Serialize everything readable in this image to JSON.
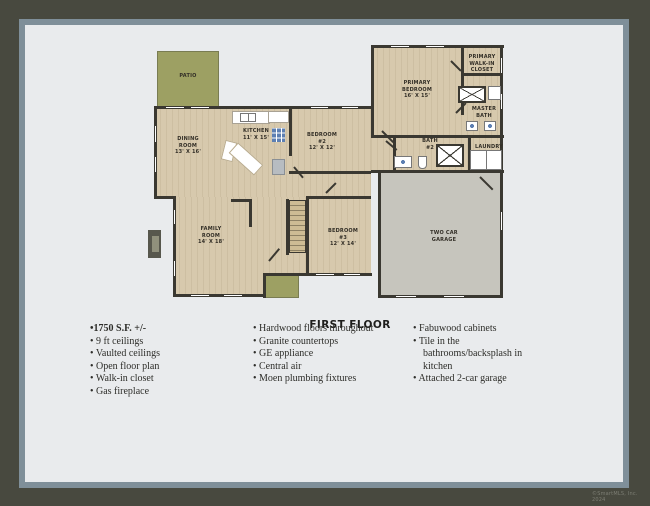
{
  "plan": {
    "title": "FIRST FLOOR",
    "rooms": [
      {
        "id": "patio",
        "label": "PATIO"
      },
      {
        "id": "dining-room",
        "label": "DINING\nROOM\n13' X 16'"
      },
      {
        "id": "kitchen",
        "label": "KITCHEN\n11' X 15'"
      },
      {
        "id": "bedroom-2",
        "label": "BEDROOM\n#2\n12' X 12'"
      },
      {
        "id": "primary-bedroom",
        "label": "PRIMARY\nBEDROOM\n16' X 15'"
      },
      {
        "id": "primary-walk-in-closet",
        "label": "PRIMARY\nWALK-IN\nCLOSET"
      },
      {
        "id": "master-bath",
        "label": "MASTER\nBATH"
      },
      {
        "id": "bath-2",
        "label": "BATH\n#2"
      },
      {
        "id": "laundry",
        "label": "LAUNDRY"
      },
      {
        "id": "family-room",
        "label": "FAMILY\nROOM\n14' X 18'"
      },
      {
        "id": "bedroom-3",
        "label": "BEDROOM\n#3\n12' X 14'"
      },
      {
        "id": "two-car-garage",
        "label": "TWO CAR\nGARAGE"
      }
    ],
    "colors": {
      "floor": "#d7c9ad",
      "wall": "#3a3831",
      "garage_floor": "#c6c5bd",
      "patio": "#9da063",
      "appliance_blue": "#5d7fb2",
      "page_background": "#e9ebed",
      "outer_frame": "#48493f",
      "mat_border": "#7f8f99"
    }
  },
  "features": {
    "col1": [
      "•1750 S.F. +/-",
      "• 9 ft ceilings",
      "• Vaulted ceilings",
      "• Open floor plan",
      "• Walk-in closet",
      "• Gas fireplace"
    ],
    "col2": [
      "• Hardwood floors throughout",
      "• Granite countertops",
      "• GE appliance",
      "• Central air",
      "• Moen plumbing fixtures"
    ],
    "col3": [
      "• Fabuwood cabinets",
      "• Tile in the\nbathrooms/backsplash in\nkitchen",
      "•  Attached 2-car garage"
    ]
  },
  "footer": {
    "copyright": "©SmartMLS, Inc. 2024"
  }
}
